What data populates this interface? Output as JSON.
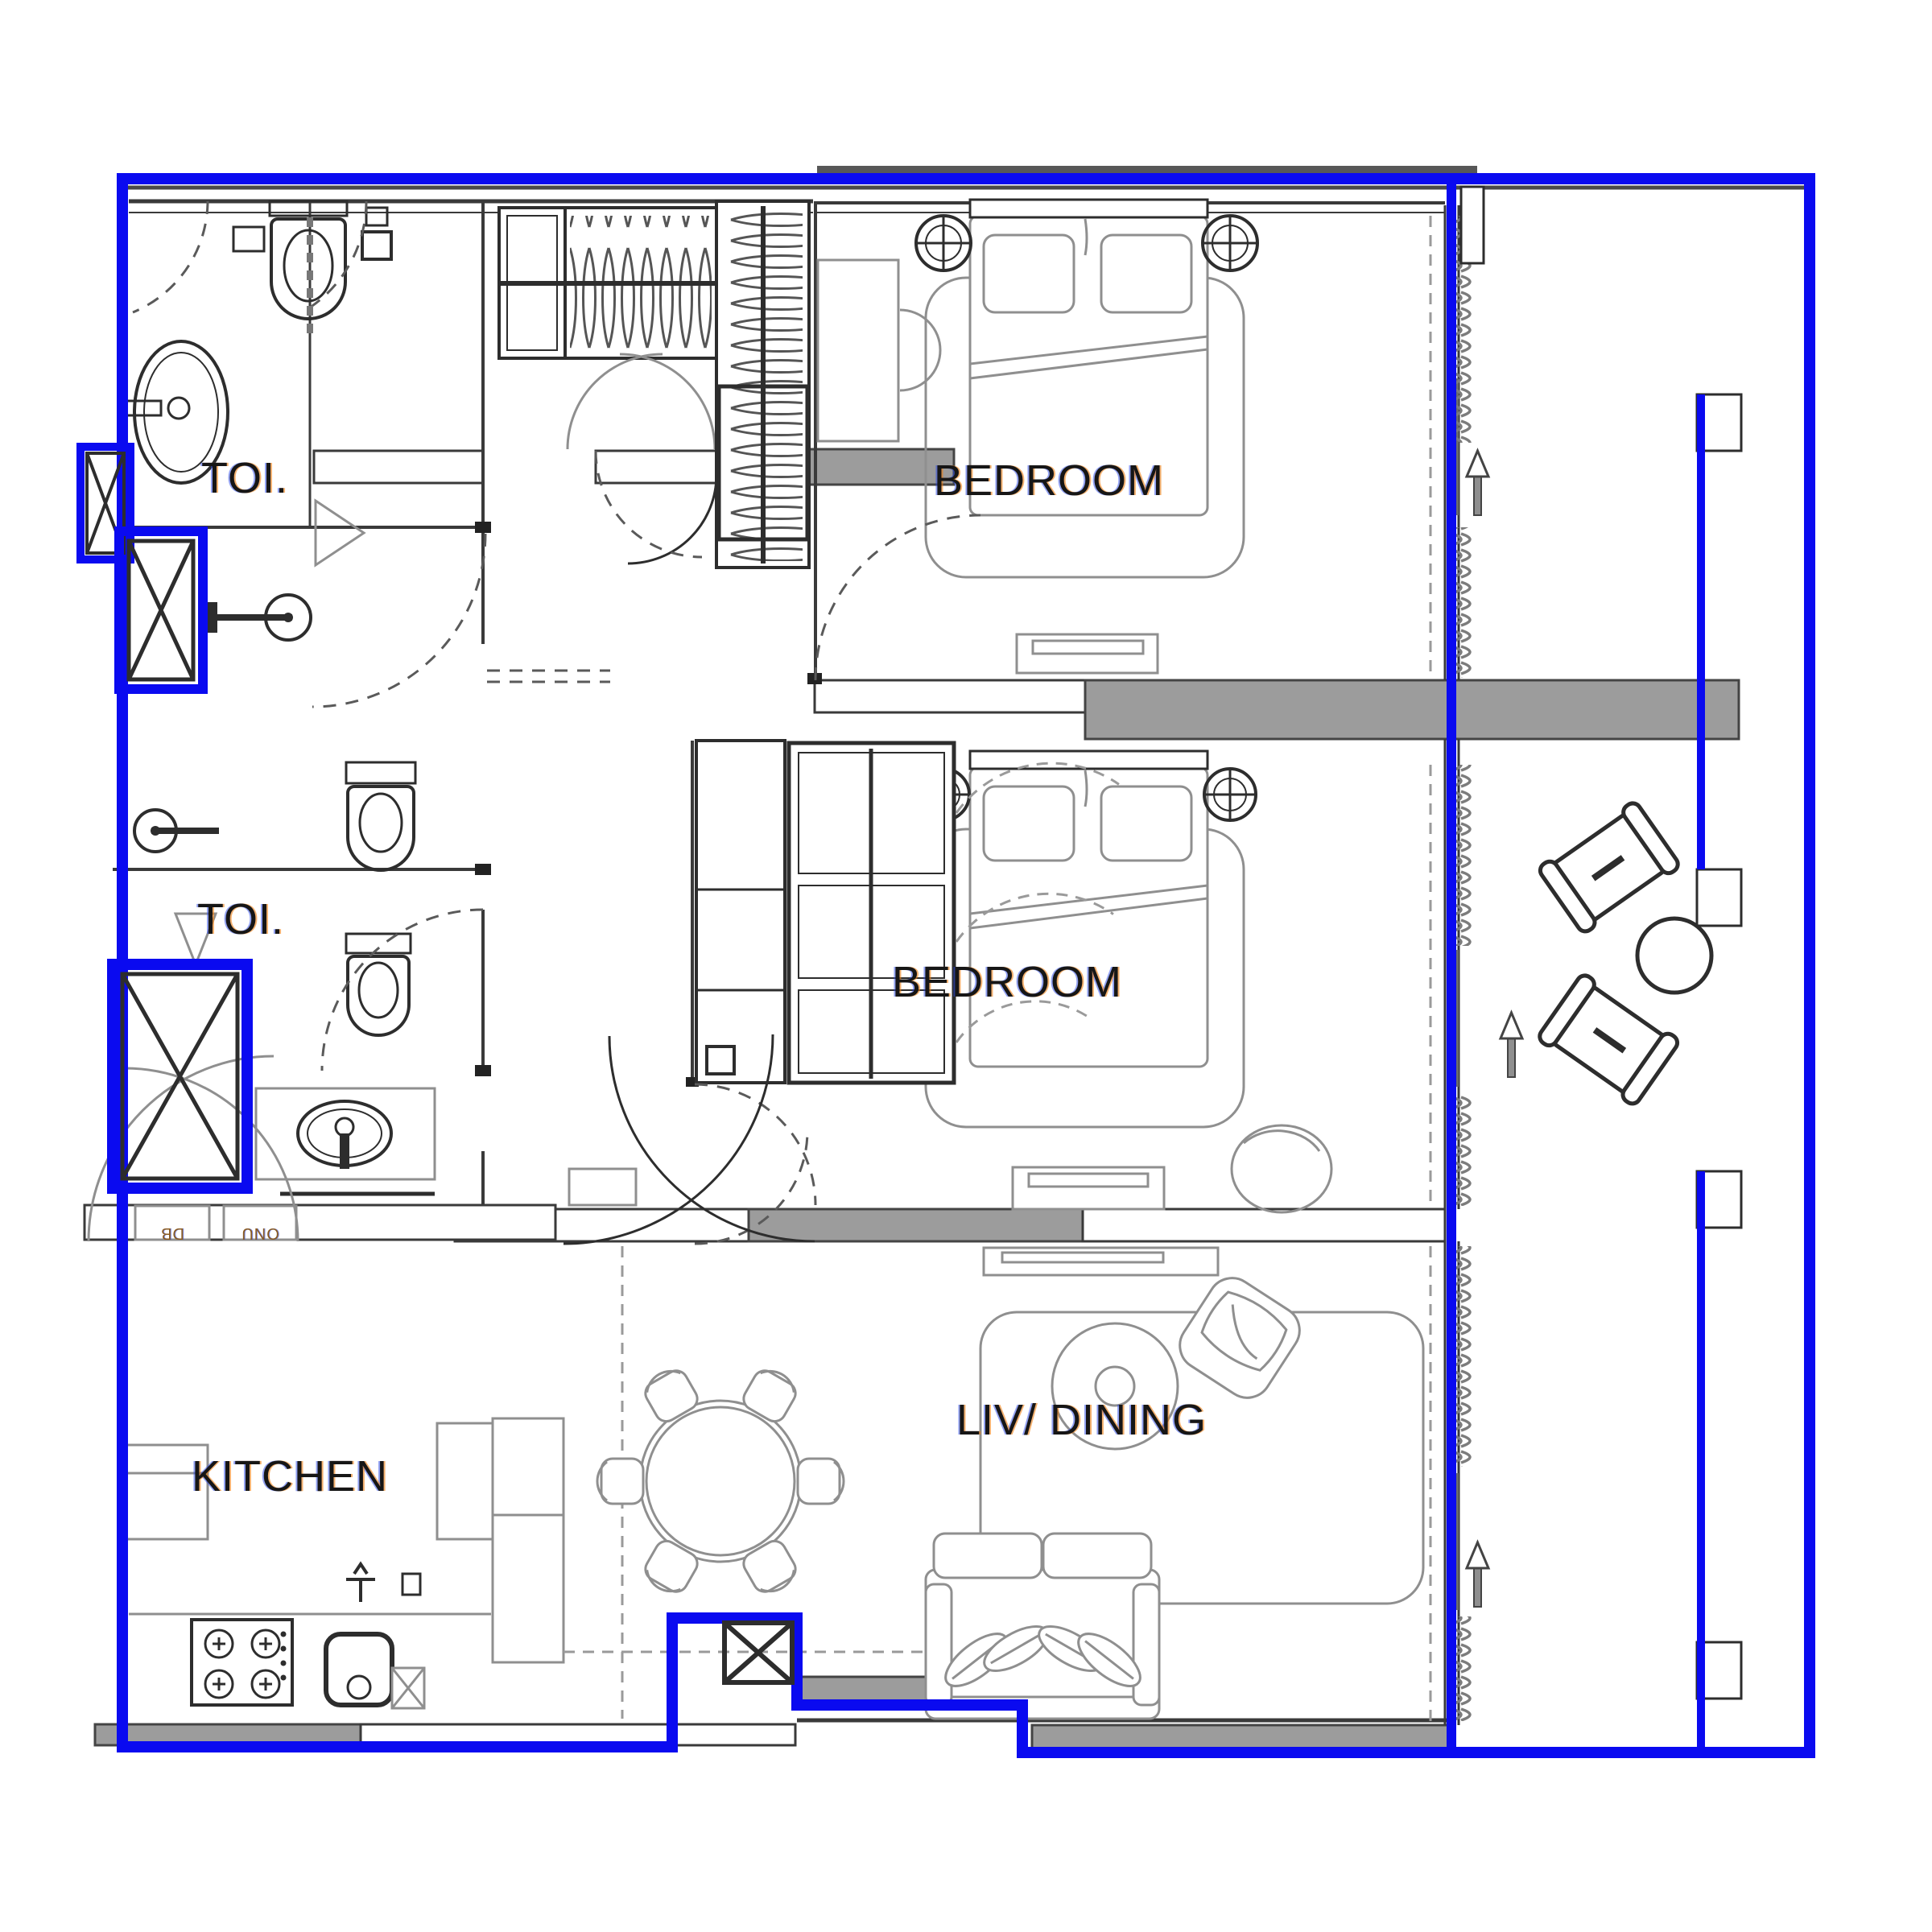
{
  "plan": {
    "type": "apartment-floor-plan",
    "unit_outline_color": "#0a0af0",
    "wall_color": "#3a3a3a",
    "party_wall_fill": "#9c9c9c",
    "furniture_line_color": "#8f8f8f",
    "rooms": {
      "toilet1": {
        "label": "TOI."
      },
      "toilet2": {
        "label": "TOI."
      },
      "bedroom1": {
        "label": "BEDROOM"
      },
      "bedroom2": {
        "label": "BEDROOM"
      },
      "kitchen": {
        "label": "KITCHEN"
      },
      "living_dining": {
        "label": "LIV/ DINING"
      }
    },
    "utility_boxes": {
      "db": "DB",
      "onu": "ONU"
    },
    "fixtures": [
      "wash-basin",
      "wc",
      "shower-head",
      "shower-drain",
      "bathtub-shower-room",
      "wardrobe-hangers",
      "double-bed-1",
      "double-bed-2",
      "bedside-lamps",
      "desk-chair",
      "tv-console",
      "gas-stove-4-burner",
      "kitchen-sink",
      "fridge",
      "round-dining-table-6-chairs",
      "sofa",
      "armchair",
      "rug-swirl",
      "balcony-chairs",
      "balcony-round-table",
      "service-shafts-x",
      "curtain-walls"
    ],
    "balcony_direction_arrows": 3
  }
}
